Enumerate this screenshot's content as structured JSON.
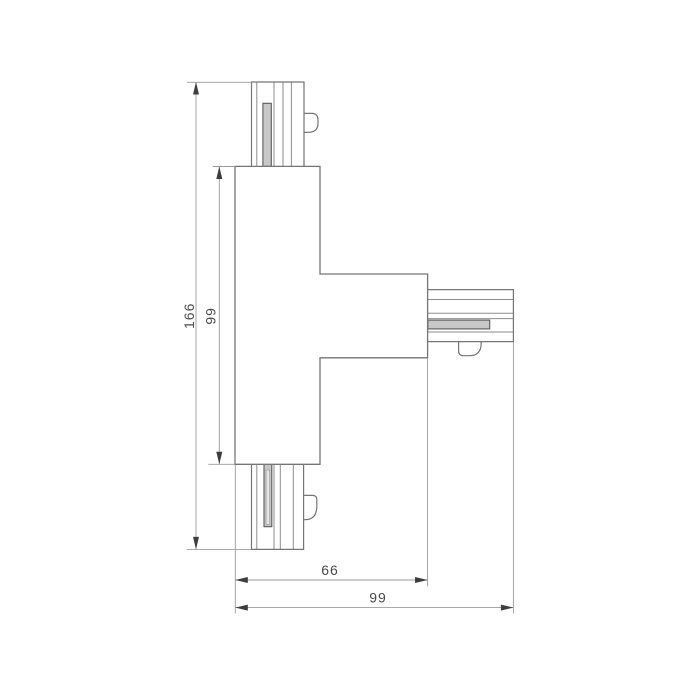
{
  "drawing": {
    "type": "technical-dimension-drawing",
    "subject": "T-shaped track connector, plan view",
    "background": "#ffffff",
    "colors": {
      "outline": "#767676",
      "stripe": "#8d8d8d",
      "conductor_fill": "#c8c8c8",
      "conductor_inner": "#e6e6e6",
      "conductor_stroke": "#5a5a5a",
      "dimension_line": "#9b9b9b",
      "arrow": "#3e3e3e",
      "text": "#4a4a4a"
    },
    "dimensions": {
      "height_total": {
        "value": "166",
        "orientation": "vertical",
        "measures": "overall height, top port end to bottom port end"
      },
      "height_body": {
        "value": "99",
        "orientation": "vertical",
        "measures": "central body height"
      },
      "width_body": {
        "value": "66",
        "orientation": "horizontal",
        "measures": "body left edge to arm end"
      },
      "width_total": {
        "value": "99",
        "orientation": "horizontal",
        "measures": "overall width, body left edge to right port end"
      }
    }
  }
}
